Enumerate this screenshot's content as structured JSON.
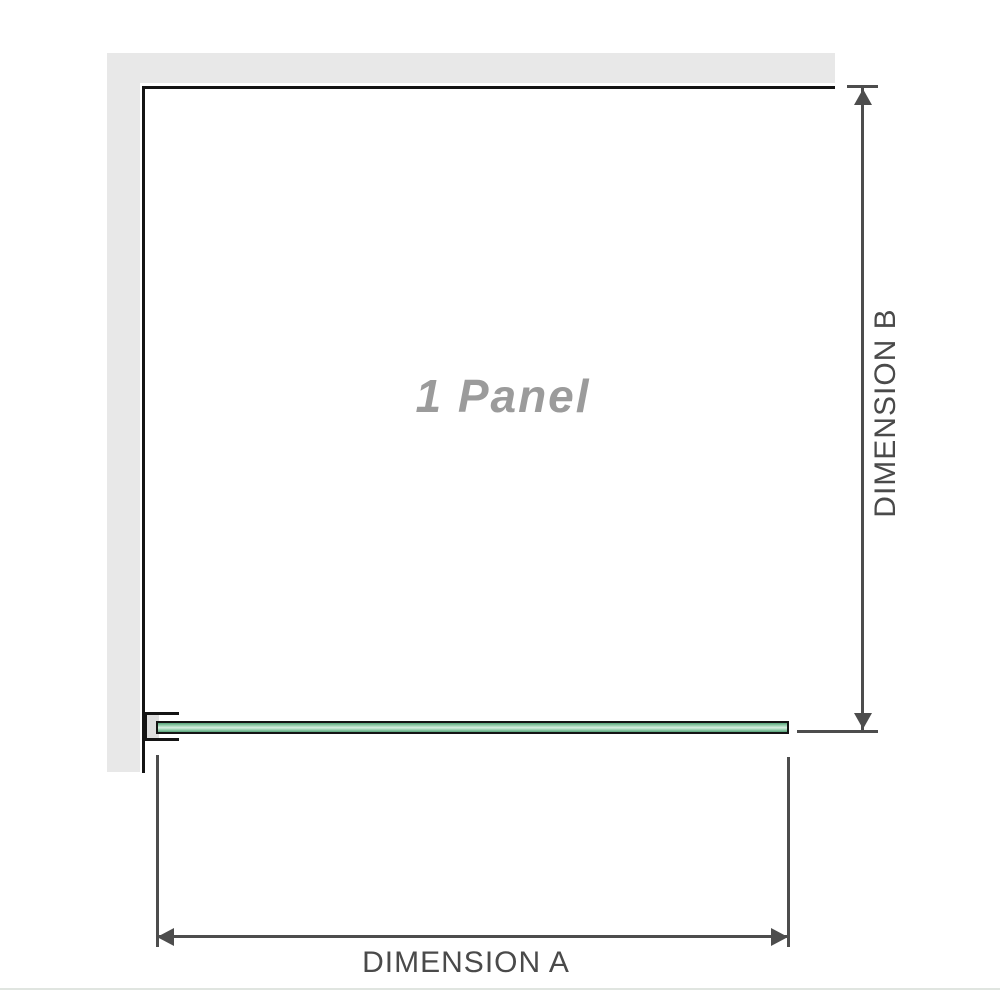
{
  "diagram": {
    "panel_label": "1 Panel",
    "dimension_a_label": "DIMENSION A",
    "dimension_b_label": "DIMENSION B"
  },
  "icons": {
    "dimension_a_arrows": "double-headed horizontal arrow",
    "dimension_b_arrows": "double-headed vertical arrow"
  },
  "colors": {
    "wall": "#e8e8e8",
    "outline": "#141414",
    "dimension": "#4d4d4d",
    "label_text": "#4a4a4a",
    "panel_text": "#9b9b9b",
    "glass_green": "#9bd2b1",
    "glass_edge": "#57a379",
    "glass_highlight": "#d9efe2",
    "bracket_fill": "#dedede",
    "divider": "#e0e5e0",
    "background": "#ffffff"
  }
}
